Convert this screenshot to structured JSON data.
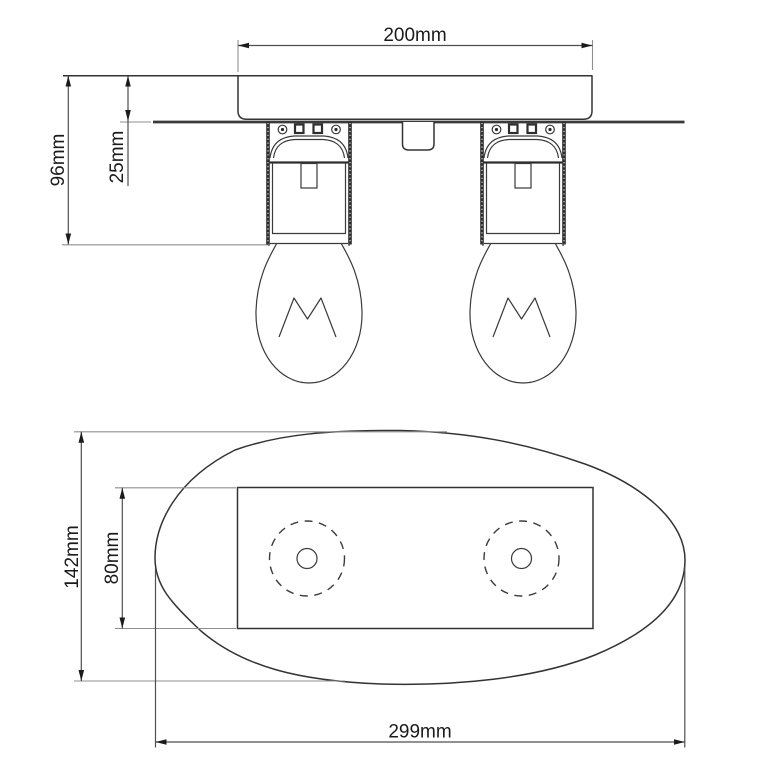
{
  "front_view": {
    "width_dim": "200mm",
    "overall_height_dim": "96mm",
    "canopy_height_dim": "25mm"
  },
  "plan_view": {
    "overall_height_dim": "142mm",
    "plate_height_dim": "80mm",
    "overall_width_dim": "299mm"
  },
  "colors": {
    "background": "#ffffff",
    "drawing_line": "#333333",
    "dimension_line": "#4f4f4f",
    "extension_line": "#8f8f8f",
    "label_text": "#1b1b1b"
  }
}
